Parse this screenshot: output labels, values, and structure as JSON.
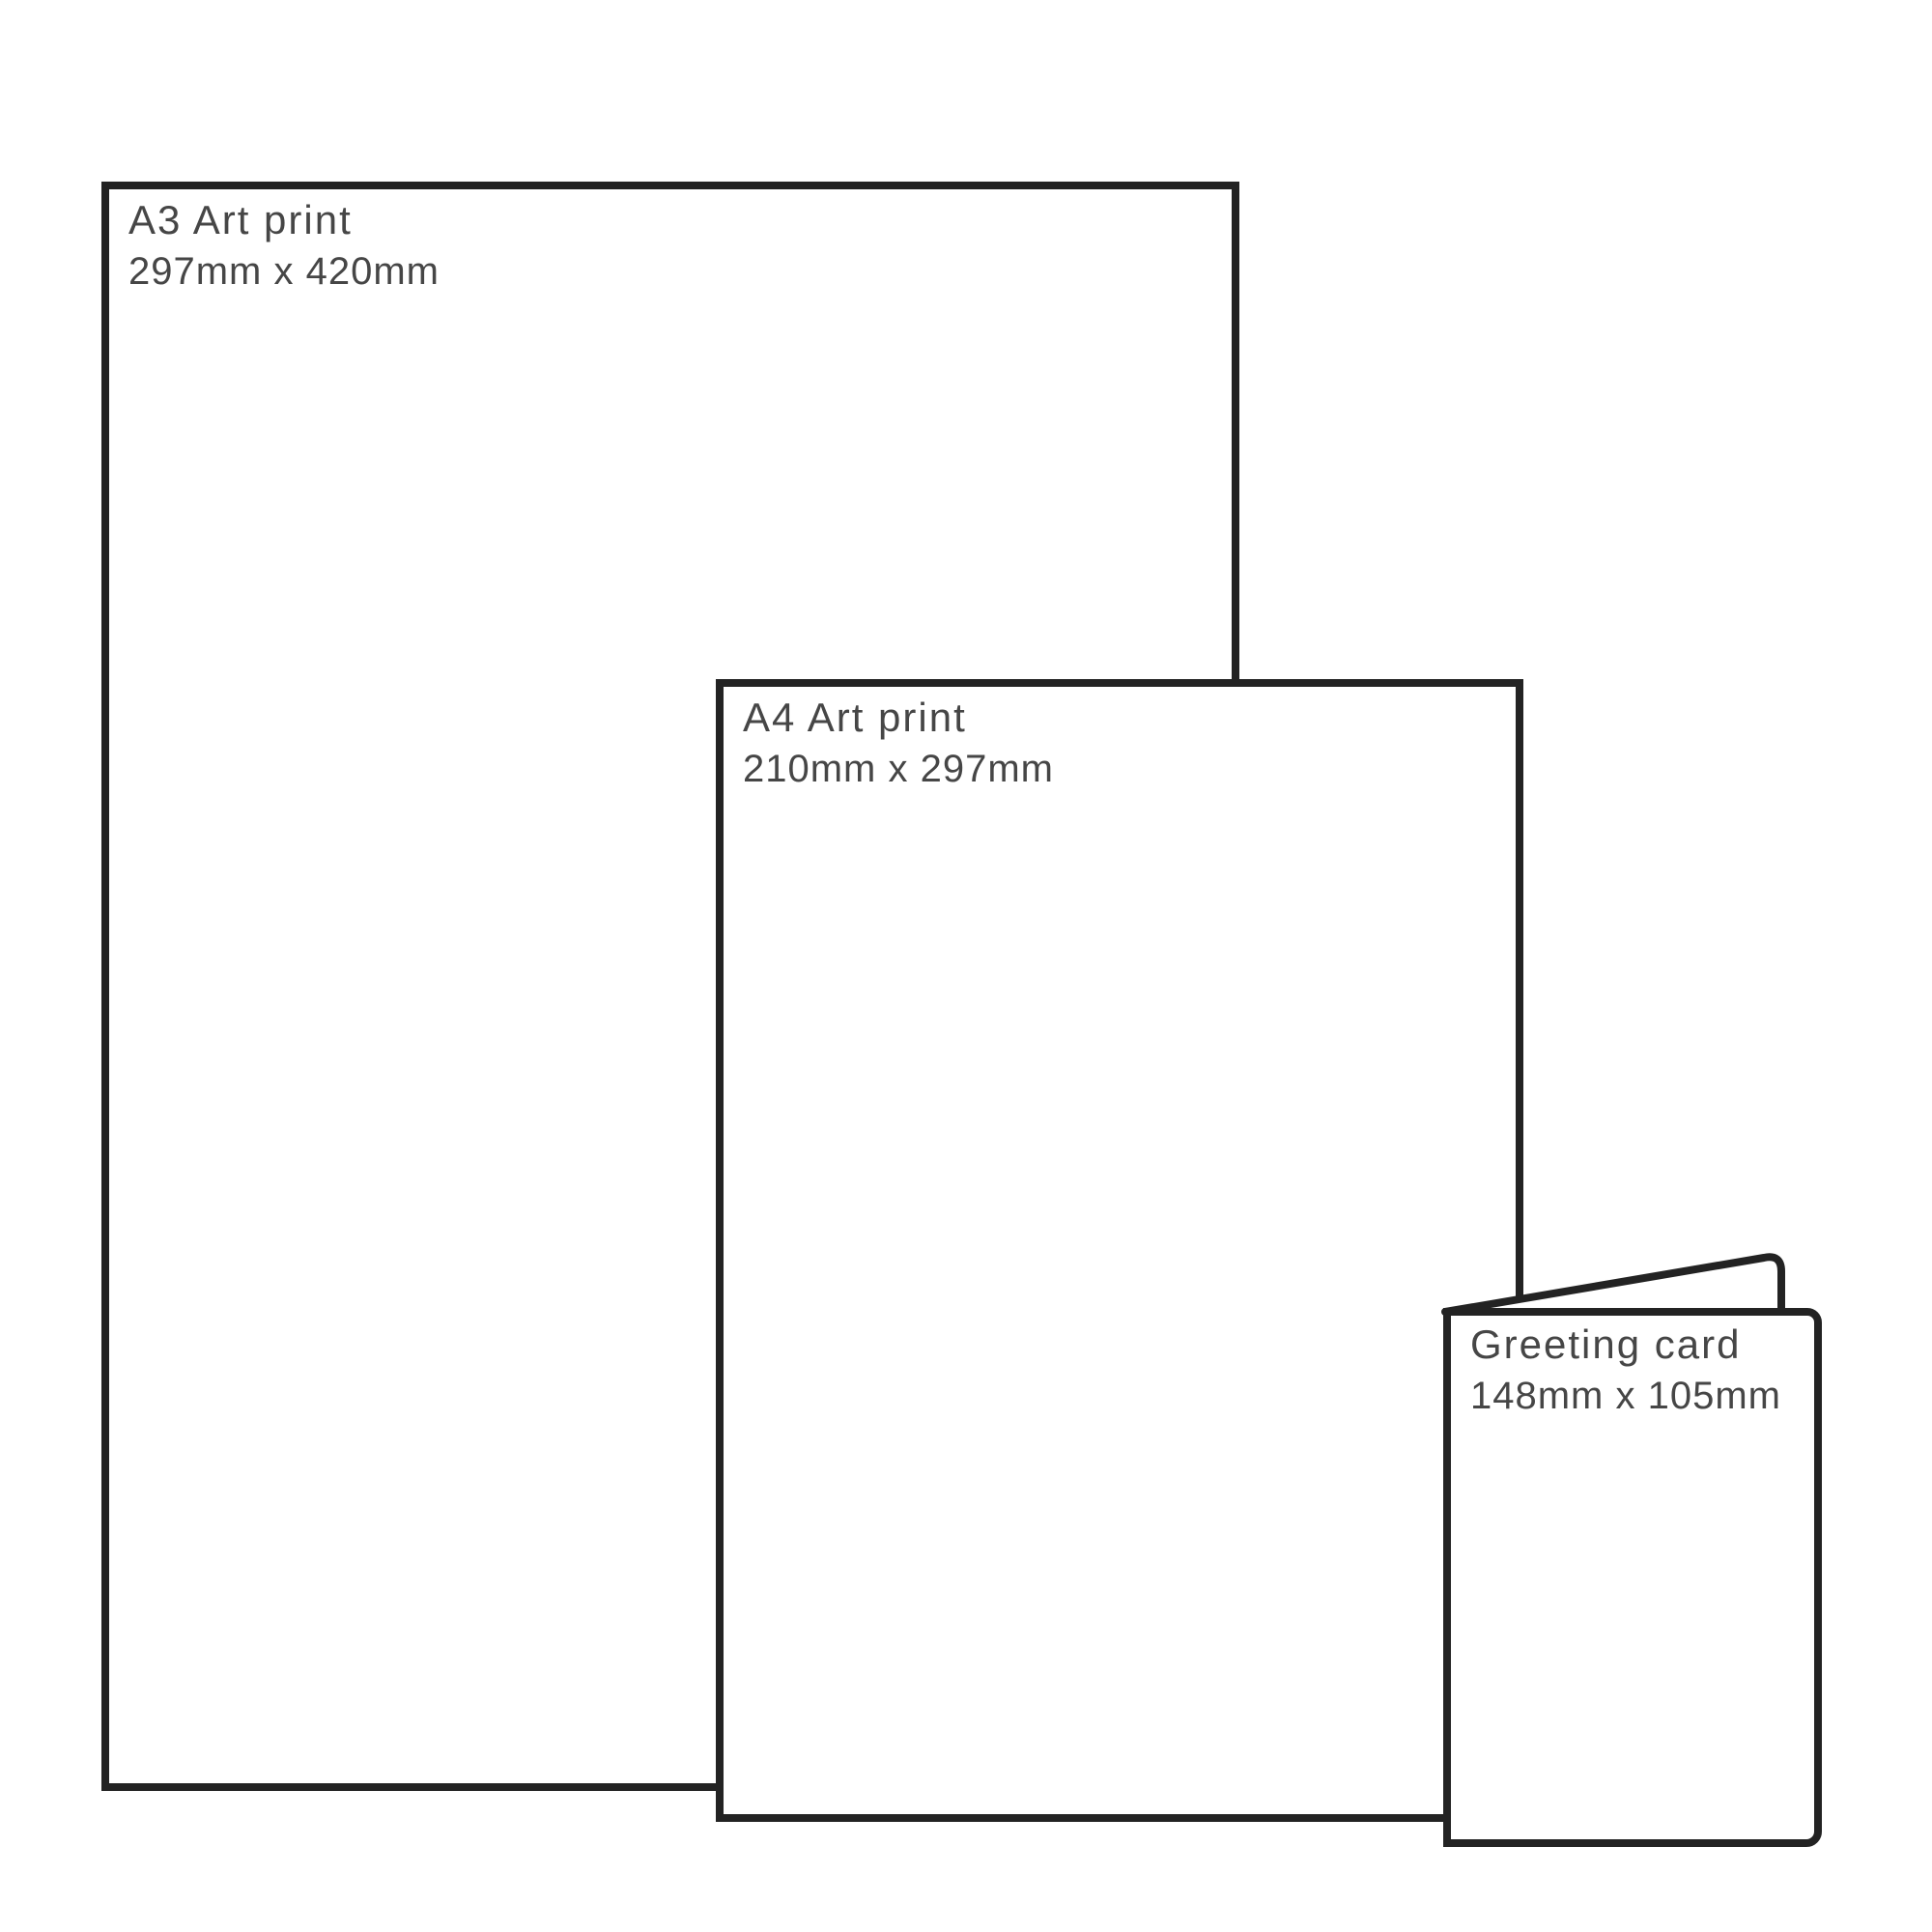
{
  "diagram": {
    "description": "Print size comparison",
    "items": [
      {
        "id": "a3-art-print",
        "title": "A3 Art print",
        "dimensions": "297mm x 420mm"
      },
      {
        "id": "a4-art-print",
        "title": "A4 Art print",
        "dimensions": "210mm x 297mm"
      },
      {
        "id": "greeting-card",
        "title": "Greeting card",
        "dimensions": "148mm x 105mm"
      }
    ],
    "colors": {
      "outline": "#232323",
      "label_text": "#464646",
      "background": "#ffffff"
    }
  }
}
